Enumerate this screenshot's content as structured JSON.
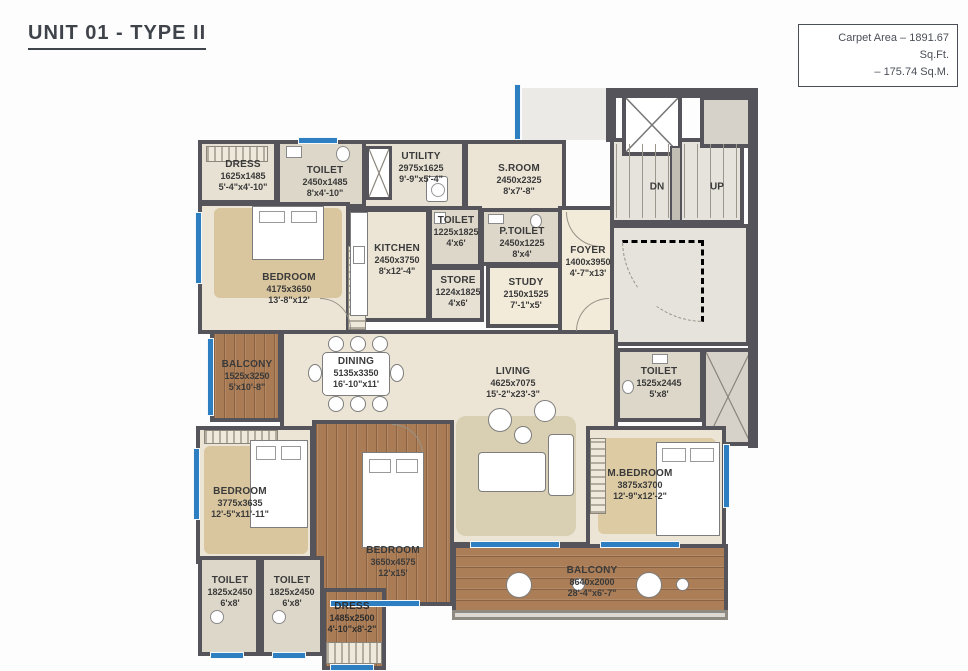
{
  "page": {
    "title": "UNIT 01 - TYPE II"
  },
  "carpet_area": {
    "line1": "Carpet Area – 1891.67 Sq.Ft.",
    "line2": "– 175.74 Sq.M."
  },
  "stairs": {
    "down_label": "DN",
    "up_label": "UP"
  },
  "colors": {
    "wall": "#54545a",
    "window_blue": "#2e7fc2",
    "floor_beige": "#ece5d6",
    "floor_tile": "#ddd7c9",
    "wood": "#aa7c55",
    "carpet_tan": "#d9c69e"
  },
  "rooms": [
    {
      "name": "DRESS",
      "mm": "1625x1485",
      "ft": "5'-4\"x4'-10\""
    },
    {
      "name": "TOILET",
      "mm": "2450x1485",
      "ft": "8'x4'-10\""
    },
    {
      "name": "UTILITY",
      "mm": "2975x1625",
      "ft": "9'-9\"x5'-4\""
    },
    {
      "name": "S.ROOM",
      "mm": "2450x2325",
      "ft": "8'x7'-8\""
    },
    {
      "name": "TOILET",
      "mm": "1225x1825",
      "ft": "4'x6'"
    },
    {
      "name": "P.TOILET",
      "mm": "2450x1225",
      "ft": "8'x4'"
    },
    {
      "name": "KITCHEN",
      "mm": "2450x3750",
      "ft": "8'x12'-4\""
    },
    {
      "name": "STORE",
      "mm": "1224x1825",
      "ft": "4'x6'"
    },
    {
      "name": "STUDY",
      "mm": "2150x1525",
      "ft": "7'-1\"x5'"
    },
    {
      "name": "FOYER",
      "mm": "1400x3950",
      "ft": "4'-7\"x13'"
    },
    {
      "name": "BEDROOM",
      "mm": "4175x3650",
      "ft": "13'-8\"x12'"
    },
    {
      "name": "BALCONY",
      "mm": "1525x3250",
      "ft": "5'x10'-8\""
    },
    {
      "name": "DINING",
      "mm": "5135x3350",
      "ft": "16'-10\"x11'"
    },
    {
      "name": "LIVING",
      "mm": "4625x7075",
      "ft": "15'-2\"x23'-3\""
    },
    {
      "name": "TOILET",
      "mm": "1525x2445",
      "ft": "5'x8'"
    },
    {
      "name": "BEDROOM",
      "mm": "3775x3635",
      "ft": "12'-5\"x11'-11\""
    },
    {
      "name": "BEDROOM",
      "mm": "3650x4575",
      "ft": "12'x15'"
    },
    {
      "name": "M.BEDROOM",
      "mm": "3875x3700",
      "ft": "12'-9\"x12'-2\""
    },
    {
      "name": "TOILET",
      "mm": "1825x2450",
      "ft": "6'x8'"
    },
    {
      "name": "TOILET",
      "mm": "1825x2450",
      "ft": "6'x8'"
    },
    {
      "name": "DRESS",
      "mm": "1485x2500",
      "ft": "4'-10\"x8'-2\""
    },
    {
      "name": "BALCONY",
      "mm": "8640x2000",
      "ft": "28'-4\"x6'-7\""
    }
  ]
}
